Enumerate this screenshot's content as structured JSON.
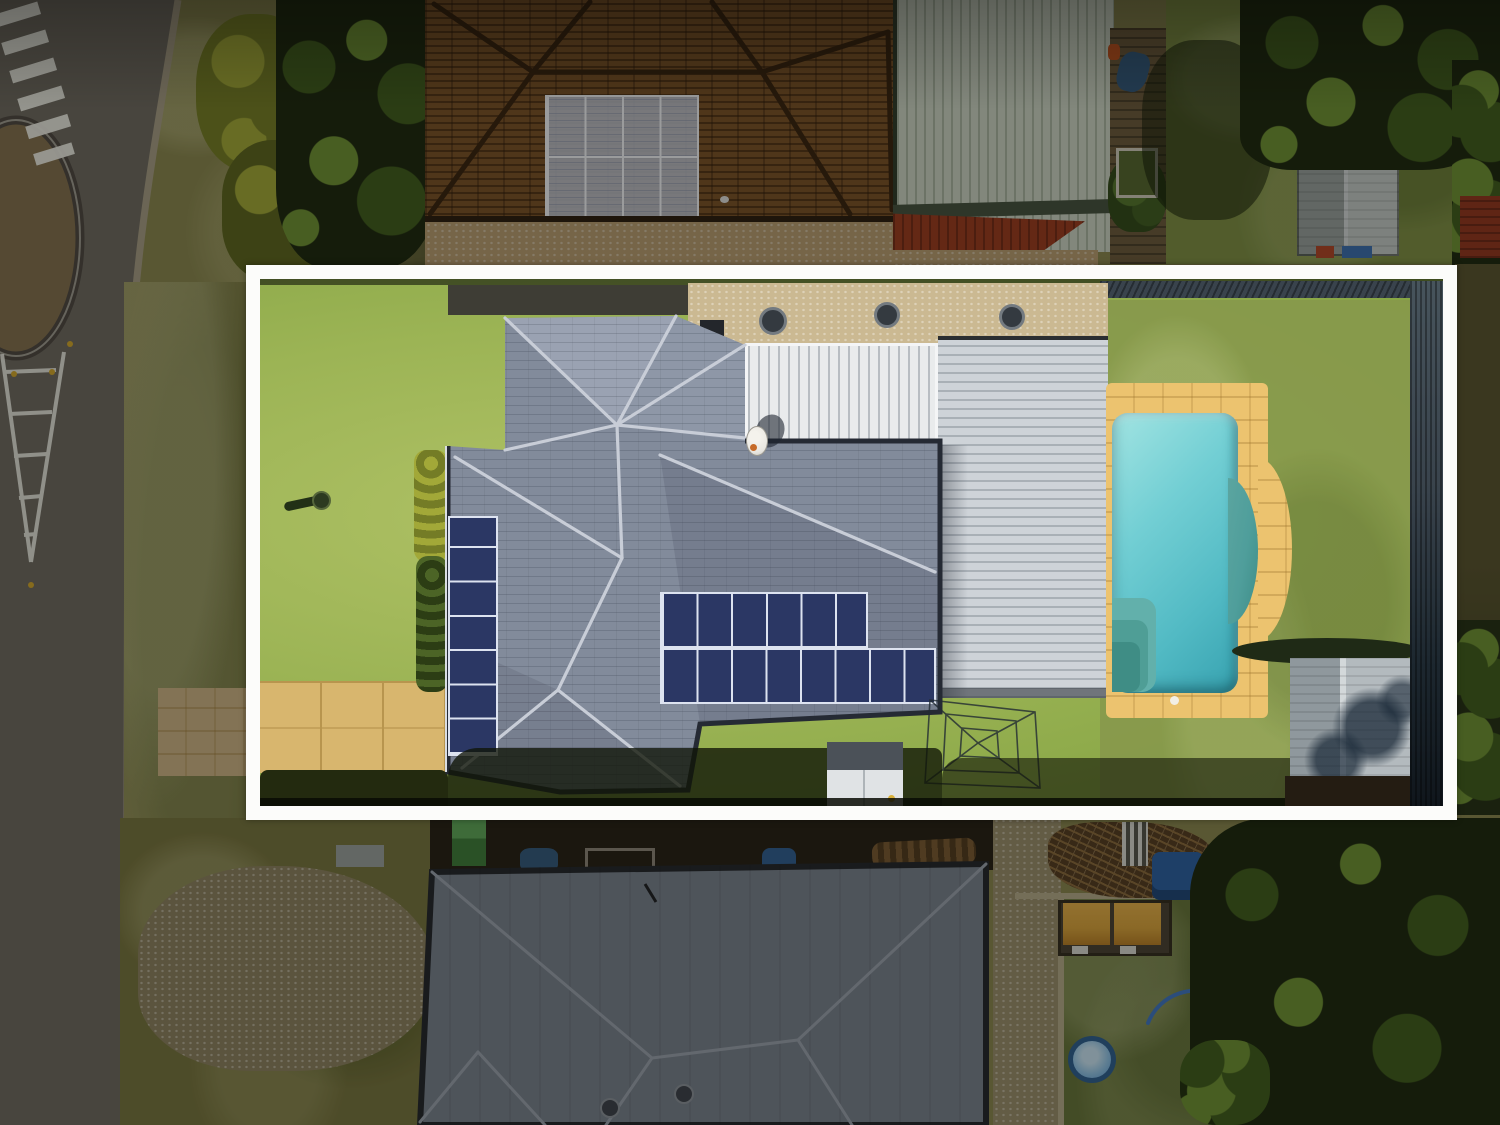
{
  "meta": {
    "type": "aerial-drone-photograph",
    "subject": "residential-property-with-white-boundary-highlight",
    "width_px": 1500,
    "height_px": 1125,
    "visible_text": "none"
  },
  "palette": {
    "road": "#6e6a62",
    "curb": "#a69d86",
    "island": "#83704f",
    "island_ring": "#4e4843",
    "marking": "#f0efe8",
    "reflector": "#d2a62c",
    "verge": "#8a8750",
    "verge_dark": "#6a6740",
    "dirt": "#8d8261",
    "concrete": "#9aa09e",
    "apron": "#cdb487",
    "hedge_y": "#a2a838",
    "hedge_y_dark": "#747c26",
    "tree_dark": "#1c280f",
    "tree_mid": "#3f5c1d",
    "tree_light": "#6f9134",
    "brown_roof": "#7a5128",
    "brown_ridge": "#38220f",
    "brown_solar": "#c3cad9",
    "gravel_warm": "#b99d72",
    "green_bldg": "#ccd4c6",
    "green_trim": "#45523f",
    "red_roof": "#9c3a20",
    "lawn_out": "#7e8f45",
    "shed_small_l": "#98a19f",
    "shed_small_r": "#c4cac8",
    "fence_green": "#3d5a36",
    "red_shed": "#93361f",
    "bldg_pale": "#bcbfb9",
    "border_white": "#fcfcfa",
    "lawn": "#9cb455",
    "lawn_deep": "#7fa03f",
    "lawn_back": "#87984c",
    "gravel_pale": "#cbb992",
    "concrete_dark": "#3e3d35",
    "tile": "#828b9b",
    "tile_light": "#9aa2b2",
    "tile_dark": "#6b7383",
    "ridge": "#c8cdd7",
    "eave": "#252a34",
    "panel": "#2b3764",
    "panel_frame": "#dde3f0",
    "patio": "#e9ebec",
    "garage": "#ced3d8",
    "paving": "#ecc36f",
    "water_hi": "#a2e4e2",
    "water": "#52bac4",
    "water_deep": "#37a2b0",
    "ledge": "#5ba5a0",
    "step": "#3f8d85",
    "shadow": "#171b0c",
    "fence_right": "#39434c",
    "fence_right_dark": "#10161c",
    "shed_l": "#8f989d",
    "shed_r": "#b3babe",
    "shed_ridge": "#d3d8da",
    "clutter": "#262016",
    "box_green": "#3e7c3b",
    "box_green_top": "#5ea75a",
    "tarp_blue": "#33597f",
    "barrel_blue": "#2f5e93",
    "wood": "#7a5a33",
    "wood_dark": "#513a1f",
    "chair_a": "#d8d8d2",
    "machine_blue": "#2b5fa3",
    "roof_b": "#78818f",
    "roof_b_ridge": "#9aa2ae",
    "roof_b_eave": "#23262c",
    "vent": "#3c424c",
    "drive_gravel": "#9a8e6c",
    "curb_light": "#b5ab8c",
    "lawn_b": "#66743a",
    "branches": "#553d22",
    "branch_hi": "#8a6a3c",
    "play_yellow": "#d9a33c",
    "play_frame": "#332d20",
    "kpool_rim": "#2e5f91",
    "kpool": "#8fc3e8",
    "hose": "#3f76c4",
    "drive_pav": "#d8b66e",
    "drive_line": "#b8954e",
    "dish": "#e8e6e0",
    "gshed_roof": "#4b5158",
    "gshed_face": "#e0e3e5"
  },
  "scene": {
    "street": {
      "features": [
        "asphalt-road",
        "pedestrian-crossing-stripes",
        "painted-chevron-median",
        "traffic-island",
        "kerb",
        "grass-verge"
      ]
    },
    "neighbour_top": {
      "features": [
        "brown-tile-hip-roof",
        "roof-solar-array",
        "gravel-bed",
        "green-metal-shed",
        "red-roof-section",
        "garden-fence",
        "lawn",
        "large-trees",
        "small-grey-shed",
        "green-fence",
        "red-shed"
      ]
    },
    "highlighted_property": {
      "boundary": "white-rectangular-outline",
      "features": [
        "front-lawn",
        "paved-driveway",
        "yellow-hedge",
        "bird-bath",
        "grey-tile-hip-roof-house",
        "west-solar-panel-strip",
        "main-solar-array",
        "white-patio-roof",
        "pale-garage-roof",
        "satellite-dish",
        "gravel-strip",
        "roof-vents",
        "swimming-pool",
        "pool-paving",
        "pool-steps",
        "pool-ledge",
        "back-lawn",
        "rotary-clothesline",
        "garden-shed",
        "corner-shed",
        "dark-boundary-fence"
      ]
    },
    "neighbour_bottom": {
      "features": [
        "dark-metal-hip-roof",
        "cluttered-yard",
        "gravel-driveway",
        "dirt-patch",
        "branch-pile",
        "play-structure-yellow-canopy",
        "kiddie-pool",
        "garden-hose",
        "large-trees",
        "lawn"
      ]
    }
  }
}
